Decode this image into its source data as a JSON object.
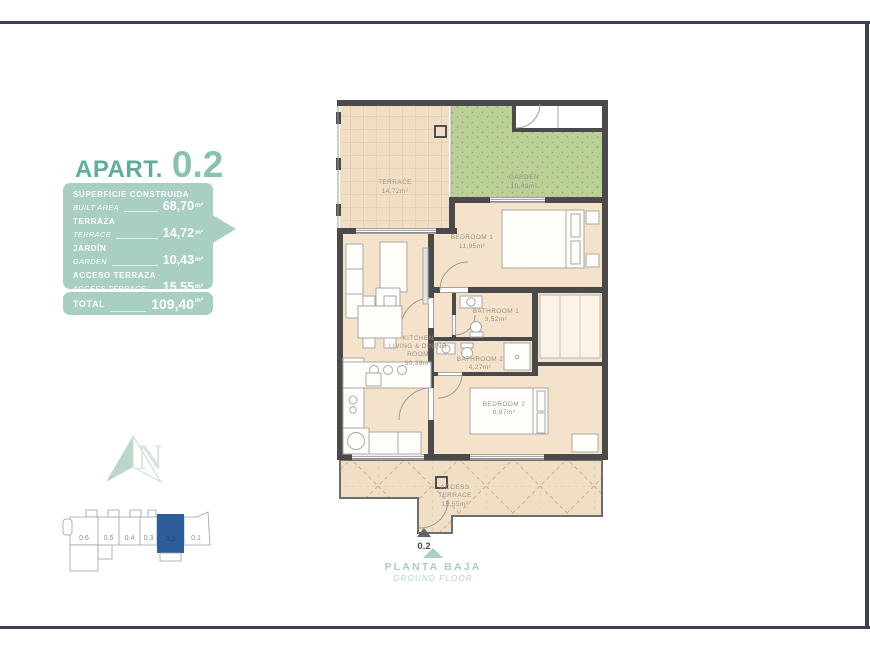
{
  "header": {
    "prefix": "APART.",
    "unit": "0.2"
  },
  "summary": {
    "rows": [
      {
        "label_es": "SUPERFICIE CONSTRUIDA",
        "label_en": "BUILT AREA",
        "value": "68,70",
        "unit": "m²"
      },
      {
        "label_es": "TERRAZA",
        "label_en": "TERRACE",
        "value": "14,72",
        "unit": "m²"
      },
      {
        "label_es": "JARDÍN",
        "label_en": "GARDEN",
        "value": "10,43",
        "unit": "m²"
      },
      {
        "label_es": "ACCESO TERRAZA",
        "label_en": "ACCESS TERRACE",
        "value": "15,55",
        "unit": "m²"
      }
    ],
    "total": {
      "label": "TOTAL",
      "value": "109,40",
      "unit": "m²"
    }
  },
  "floor_plan": {
    "labels": {
      "terrace": {
        "name": "TERRACE",
        "area": "14,72m²"
      },
      "garden": {
        "name": "GARDEN",
        "area": "10,43m²"
      },
      "bedroom1": {
        "name": "BEDROOM 1",
        "area": "11,95m²"
      },
      "bathroom1": {
        "name": "BATHROOM 1",
        "area": "3,52m²"
      },
      "bathroom2": {
        "name": "BATHROOM 2",
        "area": "4,27m²"
      },
      "kitchen": {
        "line1": "KITCHEN",
        "line2": "LIVING & DINING",
        "line3": "ROOM",
        "area": "30,29m²"
      },
      "bedroom2": {
        "name": "BEDROOM 2",
        "area": "8,97m²"
      },
      "access_terrace": {
        "line1": "ACCESS",
        "line2": "TERRACE",
        "area": "15,55m²"
      }
    },
    "entrance_label": "0.2"
  },
  "footer": {
    "floor_es": "PLANTA BAJA",
    "floor_en": "GROUND FLOOR"
  },
  "key_plan": {
    "units": [
      "0.6",
      "0.5",
      "0.4",
      "0.3",
      "0.2",
      "0.1"
    ],
    "highlighted": "0.2",
    "highlight_color": "#2e5d9c"
  },
  "compass": {
    "letter": "N"
  },
  "colors": {
    "accent_teal": "#5fae9d",
    "panel_teal": "#a9cec3",
    "frame_navy": "#3a4156",
    "plan_floor": "#f4e3ca",
    "terrace_floor": "#f1dfc5",
    "garden_green": "#bccf97",
    "wall_gray": "#4a4a4a",
    "keyplan_blue": "#2e5d9c"
  }
}
